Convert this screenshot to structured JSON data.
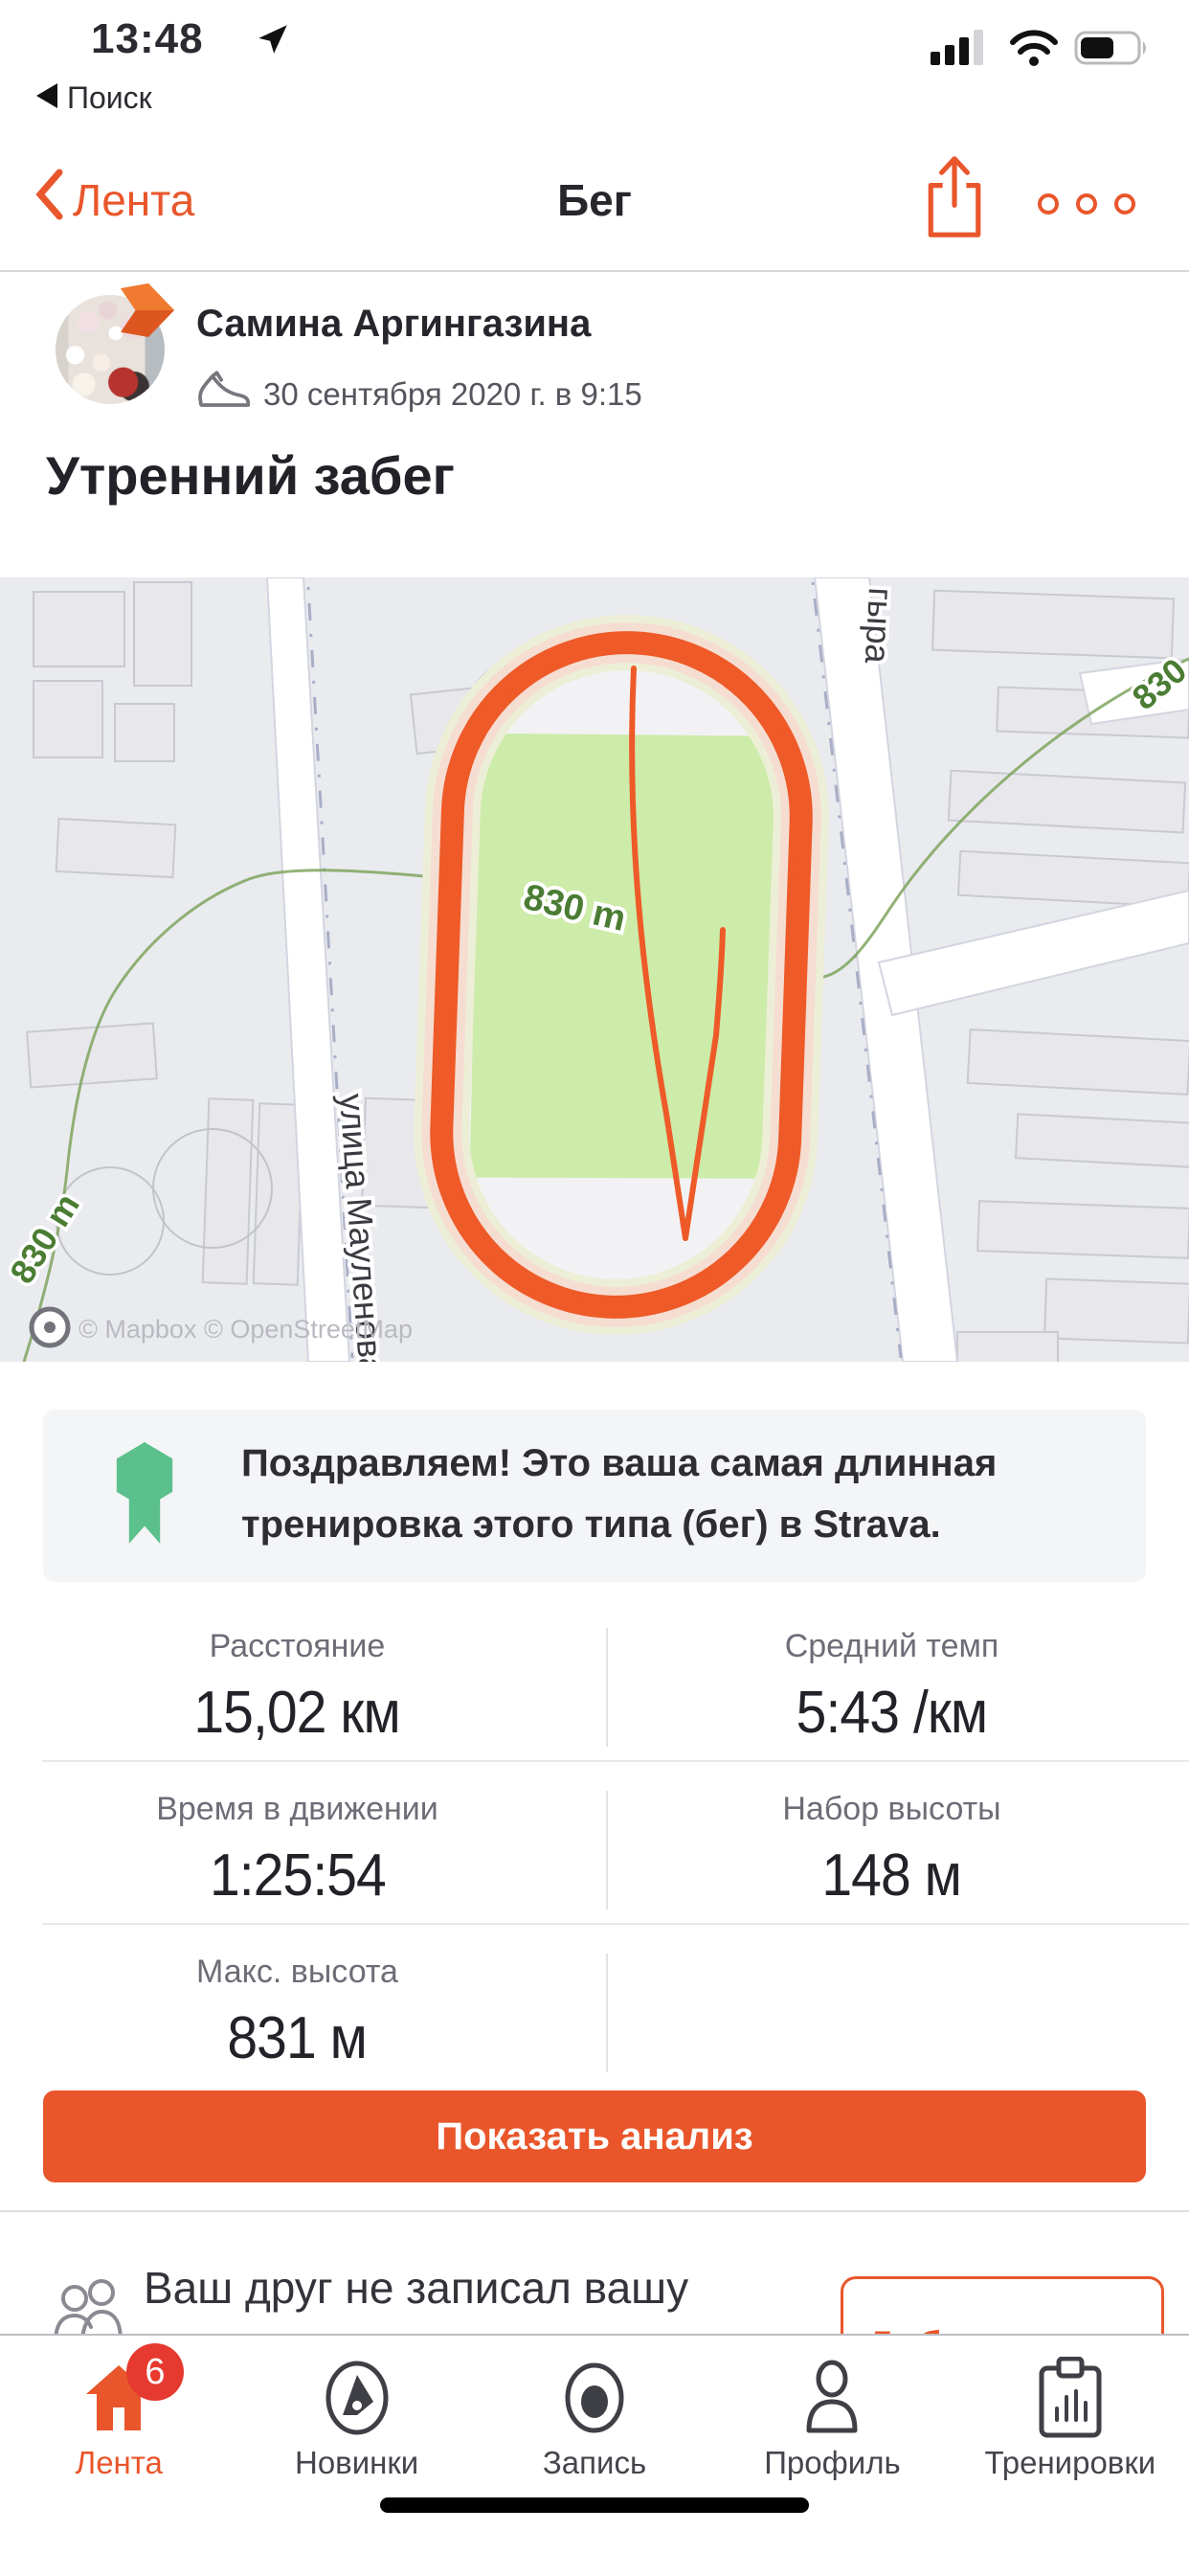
{
  "colors": {
    "accent": "#e9562b",
    "route_orange": "#ee5a28",
    "badge_red": "#e6392f",
    "ribbon_green": "#5bc08c",
    "map_bg": "#eaebef",
    "field_green": "#cdeba9",
    "contour_green": "#4a7d33",
    "halo_pink": "#f6ddd1"
  },
  "status_bar": {
    "time": "13:48",
    "back_app": "Поиск"
  },
  "nav": {
    "back_label": "Лента",
    "title": "Бег"
  },
  "activity": {
    "user_name": "Самина Аргингазина",
    "date": "30 сентября 2020 г. в 9:15",
    "title": "Утренний забег"
  },
  "map": {
    "labels": {
      "street_left": "улица Мауленова",
      "street_right": "гыра",
      "contour_center": "830 m",
      "contour_bottom": "830 m",
      "contour_top_right": "830",
      "attribution": "© Mapbox © OpenStreetMap"
    }
  },
  "banner": {
    "text": "Поздравляем! Это ваша самая длинная тренировка этого типа (бег) в Strava."
  },
  "stats": {
    "rows": [
      [
        {
          "label": "Расстояние",
          "value": "15,02 км"
        },
        {
          "label": "Средний темп",
          "value": "5:43 /км"
        }
      ],
      [
        {
          "label": "Время в движении",
          "value": "1:25:54"
        },
        {
          "label": "Набор высоты",
          "value": "148 м"
        }
      ],
      [
        {
          "label": "Макс. высота",
          "value": "831 м"
        }
      ]
    ]
  },
  "actions": {
    "show_analysis": "Показать анализ"
  },
  "friend": {
    "text": "Ваш друг не записал вашу",
    "add_button": "Добавить еще"
  },
  "tab_bar": {
    "items": [
      {
        "label": "Лента",
        "badge": "6"
      },
      {
        "label": "Новинки"
      },
      {
        "label": "Запись"
      },
      {
        "label": "Профиль"
      },
      {
        "label": "Тренировки"
      }
    ]
  },
  "icons": {
    "status": [
      "location-arrow-icon",
      "signal-icon",
      "wifi-icon",
      "battery-icon"
    ],
    "nav": [
      "back-chevron-icon",
      "share-icon",
      "ellipsis-icon"
    ],
    "activity": [
      "run-shoe-icon",
      "avatar-arrow-badge-icon"
    ],
    "banner": [
      "achievement-ribbon-icon"
    ],
    "friend": [
      "people-icon"
    ],
    "tabs": [
      "home-icon",
      "compass-icon",
      "record-icon",
      "profile-icon",
      "training-icon"
    ]
  }
}
